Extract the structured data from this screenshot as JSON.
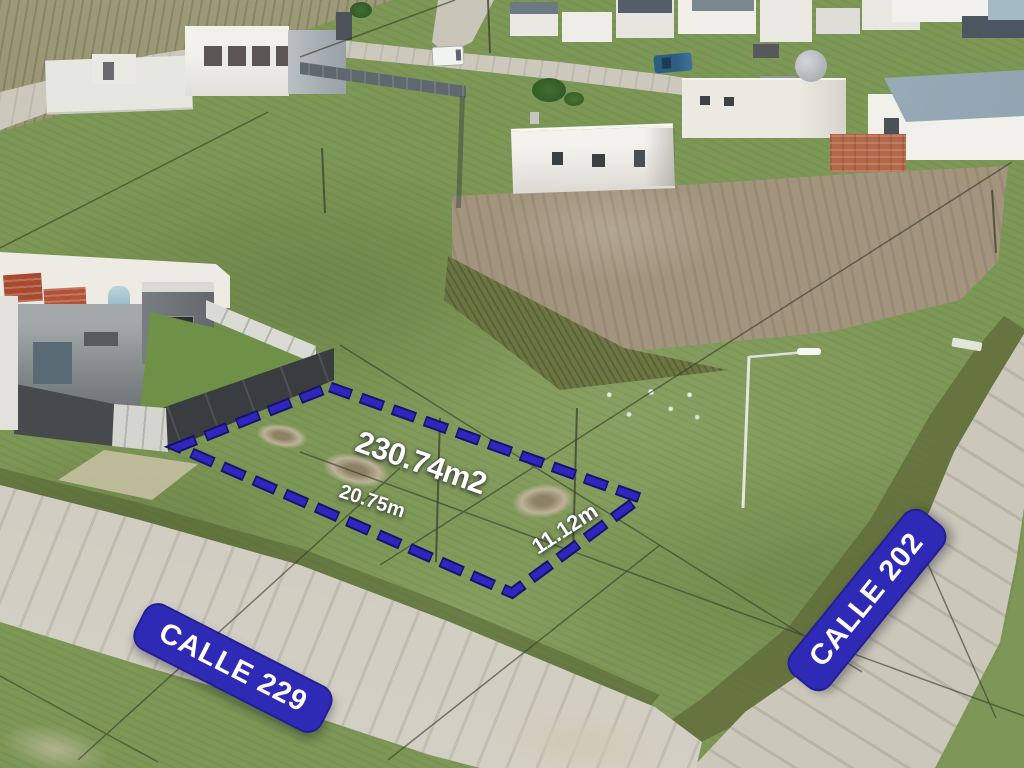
{
  "annotations": {
    "plot_outline": {
      "area_label": "230.74m2",
      "frontage_label": "20.75m",
      "side_label": "11.12m",
      "outline_color": "#2e26bd",
      "outline_shadow_color": "#18126b"
    },
    "street_signs": {
      "left_sign": "CALLE 229",
      "right_sign": "CALLE 202",
      "background_color": "#2f2ab5",
      "text_color": "#ffffff"
    }
  }
}
